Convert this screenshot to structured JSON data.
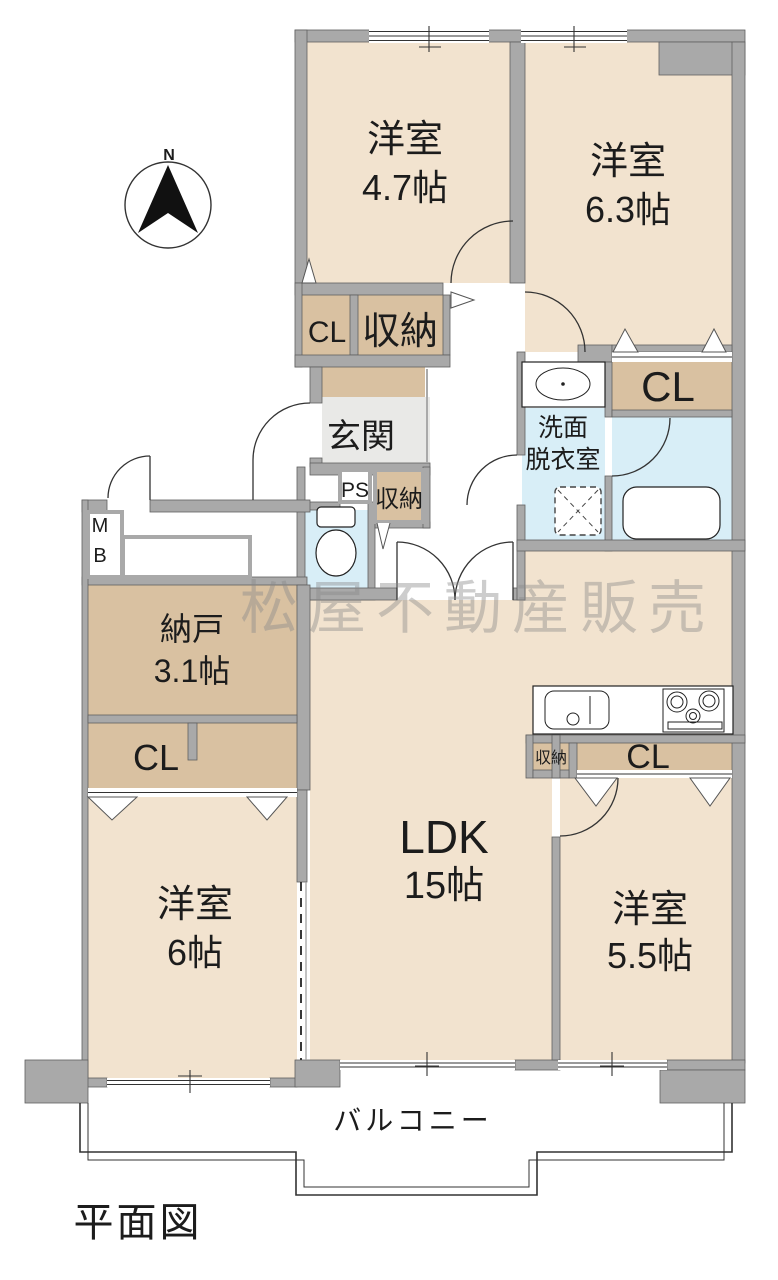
{
  "page_title": "平面図",
  "compass": {
    "label": "N"
  },
  "watermark": {
    "text": "松屋不動産販売"
  },
  "rooms": {
    "bedroom_nw": {
      "name": "洋室",
      "size": "4.7帖"
    },
    "bedroom_ne": {
      "name": "洋室",
      "size": "6.3帖"
    },
    "bedroom_w": {
      "name": "洋室",
      "size": "6帖"
    },
    "bedroom_se": {
      "name": "洋室",
      "size": "5.5帖"
    },
    "ldk": {
      "name": "LDK",
      "size": "15帖"
    },
    "storage_room": {
      "name": "納戸",
      "size": "3.1帖"
    },
    "entrance": {
      "name": "玄関"
    },
    "washroom": {
      "line1": "洗面",
      "line2": "脱衣室"
    },
    "balcony": {
      "name": "バルコニー"
    }
  },
  "closets": {
    "cl_northwest": "CL",
    "oshiire_northwest": "収納",
    "cl_northeast": "CL",
    "pipe_space": "PS",
    "oshiire_hall": "収納",
    "meter_box_line1": "M",
    "meter_box_line2": "B",
    "cl_west": "CL",
    "oshiire_kitchen": "収納",
    "cl_southeast": "CL"
  },
  "colors": {
    "room_fill": "#f2e3cf",
    "closet_fill": "#d9c1a1",
    "wet_area_fill": "#d8eef7",
    "entrance_fill": "#e9e9e7",
    "wall_fill": "#a9a9a9",
    "watermark_color": "#8a8a8a"
  }
}
